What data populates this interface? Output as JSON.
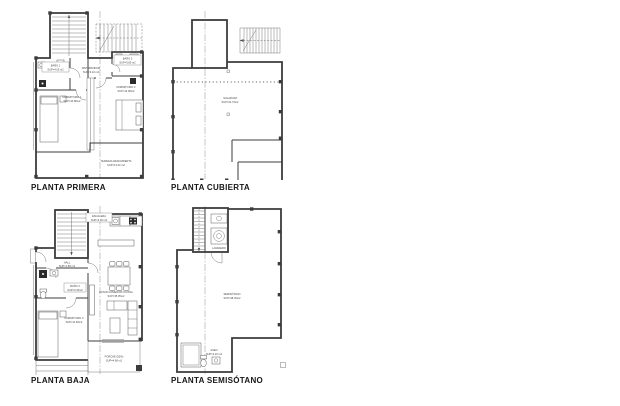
{
  "sheet": {
    "background": "#ffffff",
    "ink": "#3c3c3c"
  },
  "plans": {
    "primera": {
      "title": "PLANTA PRIMERA",
      "rooms": {
        "distribuidor": {
          "name": "DISTRIBUIDOR",
          "area": "SUP=3.10 m2"
        },
        "bano1": {
          "name": "BAÑO 1",
          "area": "SUP=4.05 m2"
        },
        "bano2": {
          "name": "BAÑO 2",
          "area": "SUP=3.85 m2"
        },
        "dormitorio1": {
          "name": "DORMITORIO 1",
          "area": "SUP=10.80m2"
        },
        "dormitorio2": {
          "name": "DORMITORIO 2",
          "area": "SUP=13.08m2"
        },
        "terraza": {
          "name": "TERRAZA DESCUBIERTA",
          "area": "SUP=13.20 m2"
        }
      }
    },
    "cubierta": {
      "title": "PLANTA CUBIERTA",
      "rooms": {
        "solarium": {
          "name": "SOLARIUM",
          "area": "SUP=41.74m2"
        }
      }
    },
    "baja": {
      "title": "PLANTA BAJA",
      "rooms": {
        "escalera": {
          "name": "ESCALERA",
          "area": "SUP=4.30 m2"
        },
        "hall": {
          "name": "HALL",
          "area": "SUP=1.80 m2"
        },
        "bano3": {
          "name": "BAÑO 3",
          "area": "SUP=3.30m2"
        },
        "dormitorio3": {
          "name": "DORMITORIO 3",
          "area": "SUP=11.50m2"
        },
        "estar": {
          "name": "ESTAR COMEDOR COCINA",
          "area": "SUP=35.05m2"
        },
        "porche": {
          "name": "PORCHE (50%)",
          "area": "SUP=4.68 m2"
        }
      }
    },
    "semisotano": {
      "title": "PLANTA SEMISÓTANO",
      "rooms": {
        "semisotano": {
          "name": "SEMISÓTANO",
          "area": "SUP=48.45m2"
        },
        "aseo": {
          "name": "ASEO",
          "area": "SUP=2.10 m2"
        },
        "lavadero": {
          "name": "LAVADERO"
        }
      }
    }
  }
}
